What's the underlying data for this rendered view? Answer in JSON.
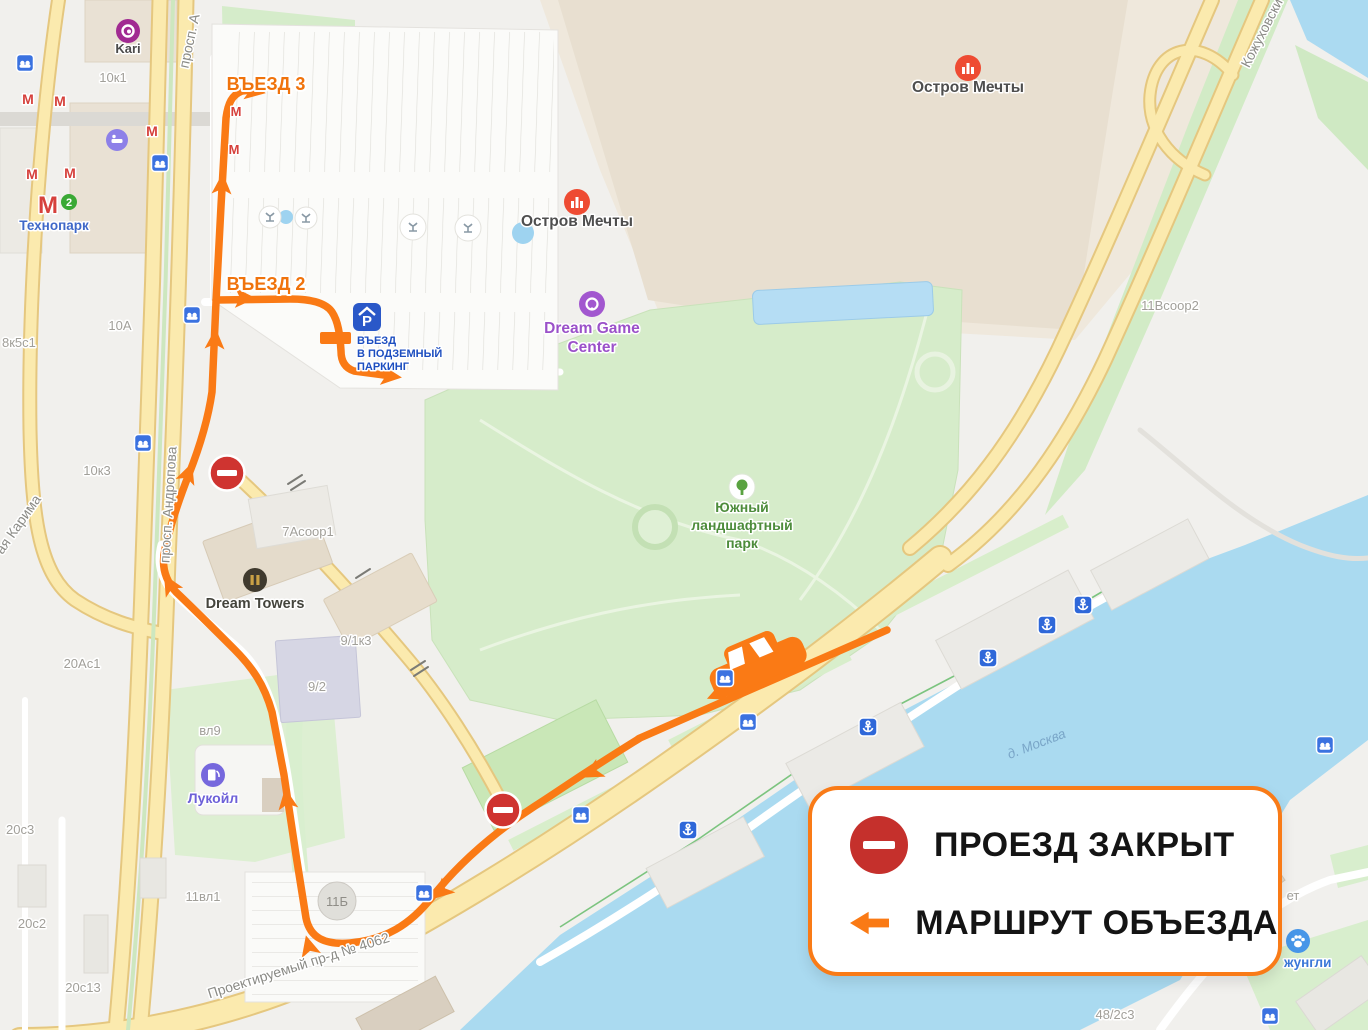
{
  "legend": {
    "road_closed": "ПРОЕЗД ЗАКРЫТ",
    "detour": "МАРШРУТ ОБЪЕЗДА"
  },
  "route": {
    "entrance_3": "ВЪЕЗД 3",
    "entrance_2": "ВЪЕЗД 2",
    "parking_line1": "ВЪЕЗД",
    "parking_line2": "В ПОДЗЕМНЫЙ",
    "parking_line3": "ПАРКИНГ",
    "parking_icon_letter": "P"
  },
  "streets": {
    "andropova": "просп. Андропова",
    "andropova_top": "просп. А",
    "karima": "ая Карима",
    "kozhukhovsky": "Кожуховски",
    "proektiruemy": "Проектируемый пр-д № 4062",
    "river": "д. Москва"
  },
  "pois": {
    "kari": "Kari",
    "technopark": "Технопарк",
    "metro_letter": "М",
    "metro_line_number": "2",
    "dream_island_top": "Остров Мечты",
    "dream_island_mid": "Остров Мечты",
    "dream_game_line1": "Dream Game",
    "dream_game_line2": "Center",
    "south_park_line1": "Южный",
    "south_park_line2": "ландшафтный",
    "south_park_line3": "парк",
    "dream_towers": "Dream Towers",
    "lukoil": "Лукойл",
    "jungle": "жунгли",
    "jungle_fragment": "ет"
  },
  "buildings": {
    "b10k1": "10к1",
    "b10a": "10А",
    "b8k5s1": "8к5с1",
    "b10k3": "10к3",
    "b7asoop1": "7Асоор1",
    "b20as1": "20Ас1",
    "b9_1k3": "9/1к3",
    "b9_2": "9/2",
    "bvl9": "вл9",
    "b20s3": "20с3",
    "b11vl1": "11вл1",
    "b11b": "11Б",
    "b20s2": "20с2",
    "b20s13": "20с13",
    "b11vsoop2": "11Всоор2",
    "b48_2s3": "48/2с3"
  },
  "colors": {
    "route_orange": "#fa7a15",
    "closed_sign_red": "#c5302c",
    "water_blue": "#aadaf0",
    "park_green": "#d6ecca",
    "road_yellow": "#fbeaae"
  }
}
